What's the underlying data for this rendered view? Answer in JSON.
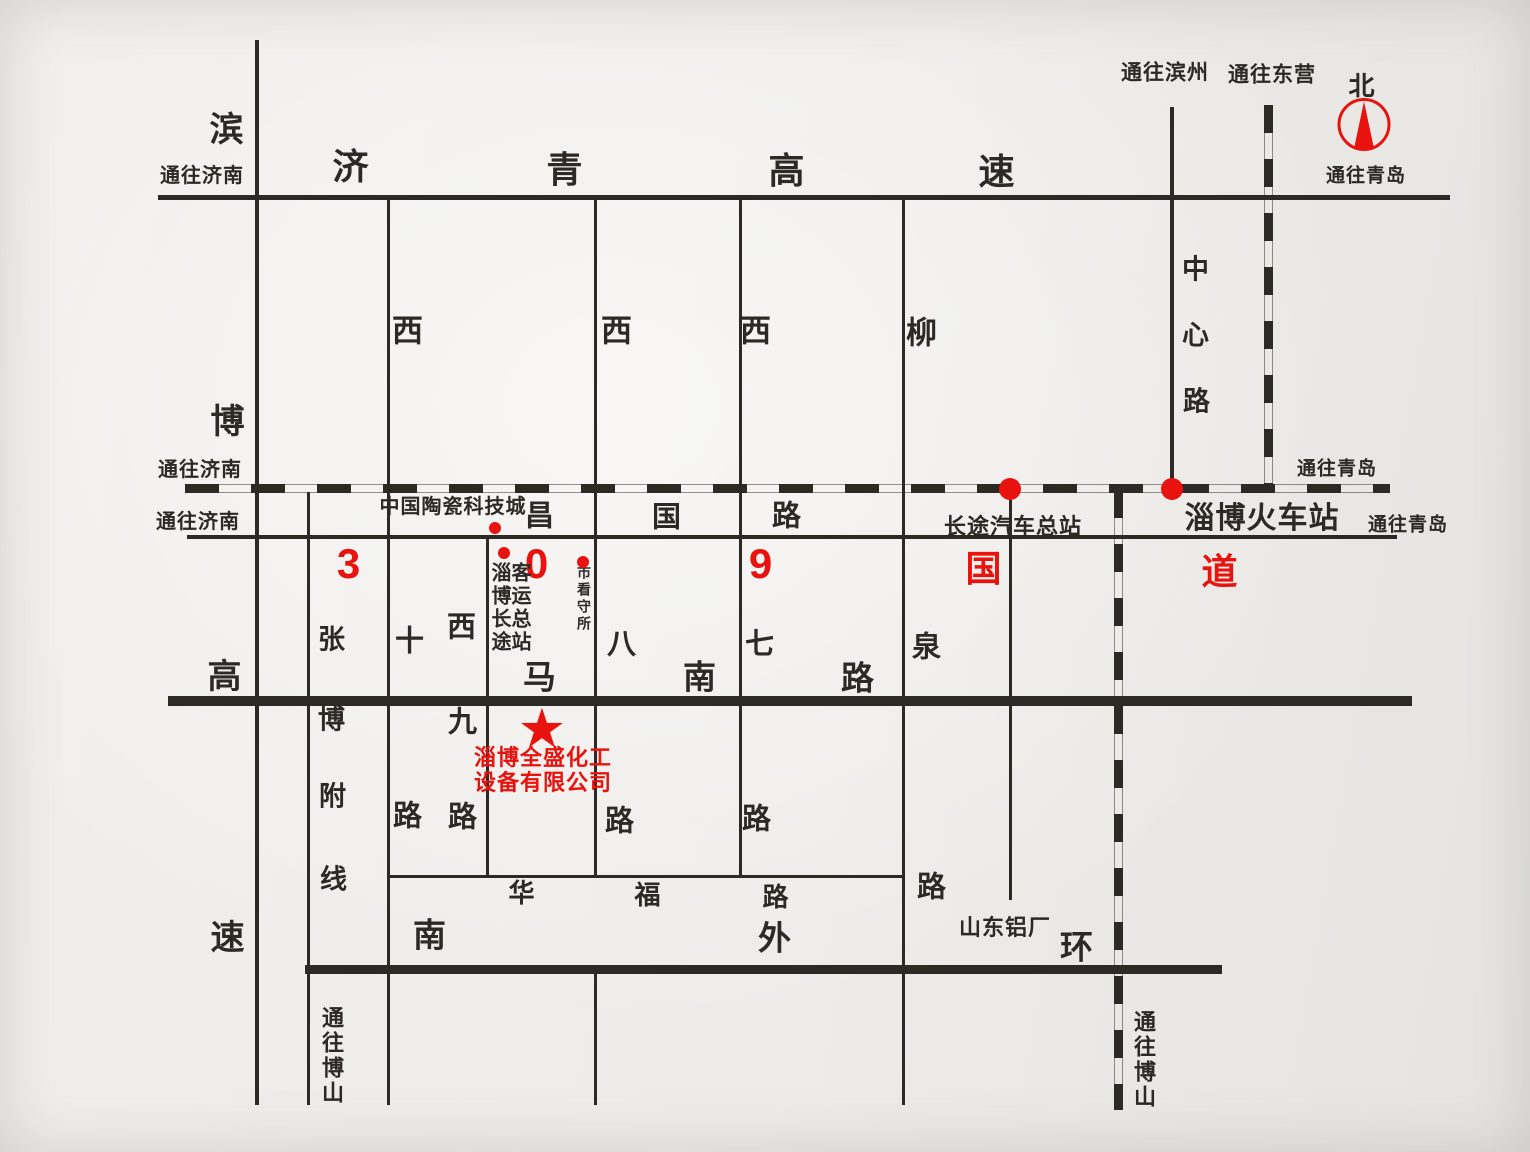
{
  "canvas": {
    "width": 1530,
    "height": 1152,
    "ink": "#2d2925",
    "red": "#e8120e"
  },
  "map_title": "淄博全盛化工设备有限公司位置示意图",
  "roads": [
    {
      "name": "jiqing-expressway",
      "orient": "h",
      "kind": "solid",
      "x": 158,
      "y": 197,
      "len": 1292,
      "w": 5
    },
    {
      "name": "railway-main",
      "orient": "h",
      "kind": "rail",
      "x": 185,
      "y": 488,
      "len": 1205,
      "w": 9
    },
    {
      "name": "changguo-road-g309",
      "orient": "h",
      "kind": "solid",
      "x": 187,
      "y": 537,
      "len": 1210,
      "w": 4
    },
    {
      "name": "manan-road",
      "orient": "h",
      "kind": "thick",
      "x": 168,
      "y": 701,
      "len": 1244,
      "w": 10
    },
    {
      "name": "huafu-road",
      "orient": "h",
      "kind": "solid",
      "x": 387,
      "y": 876,
      "len": 516,
      "w": 3
    },
    {
      "name": "nanwaihuan-road",
      "orient": "h",
      "kind": "thick",
      "x": 305,
      "y": 969,
      "len": 917,
      "w": 9
    },
    {
      "name": "binbo-expressway",
      "orient": "v",
      "kind": "solid",
      "x": 257,
      "y": 40,
      "len": 1065,
      "w": 4
    },
    {
      "name": "zhangbo-fuxian",
      "orient": "v",
      "kind": "solid",
      "x": 308,
      "y": 492,
      "len": 613,
      "w": 3
    },
    {
      "name": "xishi-road",
      "orient": "v",
      "kind": "solid",
      "x": 388,
      "y": 198,
      "len": 907,
      "w": 3
    },
    {
      "name": "xijiu-road",
      "orient": "v",
      "kind": "solid",
      "x": 487,
      "y": 537,
      "len": 339,
      "w": 3
    },
    {
      "name": "xiba-road-upper",
      "orient": "v",
      "kind": "solid",
      "x": 595,
      "y": 198,
      "len": 678,
      "w": 3
    },
    {
      "name": "xiba-road-lower",
      "orient": "v",
      "kind": "solid",
      "x": 595,
      "y": 969,
      "len": 136,
      "w": 3
    },
    {
      "name": "xiqi-road",
      "orient": "v",
      "kind": "solid",
      "x": 740,
      "y": 198,
      "len": 678,
      "w": 3
    },
    {
      "name": "liuquan-road",
      "orient": "v",
      "kind": "solid",
      "x": 903,
      "y": 198,
      "len": 907,
      "w": 3
    },
    {
      "name": "station-spur",
      "orient": "v",
      "kind": "solid",
      "x": 1010,
      "y": 490,
      "len": 410,
      "w": 3
    },
    {
      "name": "zhongxin-road",
      "orient": "v",
      "kind": "solid",
      "x": 1172,
      "y": 107,
      "len": 382,
      "w": 4
    },
    {
      "name": "railway-south-branch",
      "orient": "v",
      "kind": "rail",
      "x": 1118,
      "y": 490,
      "len": 620,
      "w": 9
    },
    {
      "name": "railway-north-branch",
      "orient": "v",
      "kind": "rail",
      "x": 1268,
      "y": 105,
      "len": 383,
      "w": 9
    }
  ],
  "labels": [
    {
      "n": "to-jinan-top",
      "t": "通往济南",
      "x": 202,
      "y": 176,
      "s": 20
    },
    {
      "n": "binbo-char-bin",
      "t": "滨",
      "x": 227,
      "y": 130,
      "s": 34
    },
    {
      "n": "jiqing-char-ji",
      "t": "济",
      "x": 351,
      "y": 167,
      "s": 36
    },
    {
      "n": "jiqing-char-qing",
      "t": "青",
      "x": 565,
      "y": 170,
      "s": 36
    },
    {
      "n": "jiqing-char-gao",
      "t": "高",
      "x": 787,
      "y": 171,
      "s": 36
    },
    {
      "n": "jiqing-char-su",
      "t": "速",
      "x": 997,
      "y": 172,
      "s": 36
    },
    {
      "n": "to-binzhou",
      "t": "通往滨州",
      "x": 1165,
      "y": 73,
      "s": 21
    },
    {
      "n": "to-dongying",
      "t": "通往东营",
      "x": 1272,
      "y": 75,
      "s": 21
    },
    {
      "n": "north-char",
      "t": "北",
      "x": 1362,
      "y": 86,
      "s": 26
    },
    {
      "n": "to-qingdao-compass",
      "t": "通往青岛",
      "x": 1366,
      "y": 176,
      "s": 19
    },
    {
      "n": "xishi-char-xi",
      "t": "西",
      "x": 408,
      "y": 331,
      "s": 31
    },
    {
      "n": "xiba-char-xi",
      "t": "西",
      "x": 617,
      "y": 331,
      "s": 31
    },
    {
      "n": "xiqi-char-xi",
      "t": "西",
      "x": 756,
      "y": 331,
      "s": 31
    },
    {
      "n": "liuquan-char-liu",
      "t": "柳",
      "x": 922,
      "y": 333,
      "s": 31
    },
    {
      "n": "zhongxin-char-zhong",
      "t": "中",
      "x": 1196,
      "y": 270,
      "s": 27
    },
    {
      "n": "zhongxin-char-xin",
      "t": "心",
      "x": 1196,
      "y": 336,
      "s": 27
    },
    {
      "n": "zhongxin-char-lu",
      "t": "路",
      "x": 1197,
      "y": 402,
      "s": 27
    },
    {
      "n": "binbo-char-bo",
      "t": "博",
      "x": 228,
      "y": 422,
      "s": 34
    },
    {
      "n": "to-jinan-rail",
      "t": "通往济南",
      "x": 200,
      "y": 470,
      "s": 20
    },
    {
      "n": "to-qingdao-rail",
      "t": "通往青岛",
      "x": 1337,
      "y": 469,
      "s": 19
    },
    {
      "n": "to-jinan-road",
      "t": "通往济南",
      "x": 198,
      "y": 522,
      "s": 20
    },
    {
      "n": "ceramics-city",
      "t": "中国陶瓷科技城",
      "x": 453,
      "y": 507,
      "s": 20
    },
    {
      "n": "changguo-char-chang",
      "t": "昌",
      "x": 540,
      "y": 517,
      "s": 29
    },
    {
      "n": "changguo-char-guo",
      "t": "国",
      "x": 667,
      "y": 518,
      "s": 29
    },
    {
      "n": "changguo-char-lu",
      "t": "路",
      "x": 787,
      "y": 517,
      "s": 29
    },
    {
      "n": "bus-terminal",
      "t": "长途汽车总站",
      "x": 1013,
      "y": 527,
      "s": 22
    },
    {
      "n": "train-station",
      "t": "淄博火车站",
      "x": 1262,
      "y": 519,
      "s": 30
    },
    {
      "n": "to-qingdao-road",
      "t": "通往青岛",
      "x": 1408,
      "y": 525,
      "s": 19
    },
    {
      "n": "g309-char-3",
      "t": "3",
      "x": 349,
      "y": 564,
      "s": 42,
      "c": "red"
    },
    {
      "n": "g309-char-0",
      "t": "0",
      "x": 537,
      "y": 564,
      "s": 42,
      "c": "red"
    },
    {
      "n": "g309-char-9",
      "t": "9",
      "x": 761,
      "y": 564,
      "s": 42,
      "c": "red"
    },
    {
      "n": "g309-char-guo",
      "t": "国",
      "x": 984,
      "y": 569,
      "s": 36,
      "c": "red"
    },
    {
      "n": "g309-char-dao",
      "t": "道",
      "x": 1220,
      "y": 572,
      "s": 36,
      "c": "red"
    },
    {
      "n": "coach-station-col1",
      "t": "淄博长途",
      "x": 499,
      "y": 608,
      "s": 20,
      "o": "v"
    },
    {
      "n": "coach-station-col2",
      "t": "客运总站",
      "x": 519,
      "y": 608,
      "s": 20,
      "o": "v"
    },
    {
      "n": "detention-house",
      "t": "市看守所",
      "x": 584,
      "y": 599,
      "s": 14,
      "o": "v"
    },
    {
      "n": "zhangbo-char-zhang",
      "t": "张",
      "x": 332,
      "y": 640,
      "s": 27
    },
    {
      "n": "xishi-char-shi",
      "t": "十",
      "x": 410,
      "y": 642,
      "s": 29
    },
    {
      "n": "xijiu-char-xi",
      "t": "西",
      "x": 462,
      "y": 628,
      "s": 29
    },
    {
      "n": "xiba-char-ba",
      "t": "八",
      "x": 622,
      "y": 645,
      "s": 29
    },
    {
      "n": "xiqi-char-qi",
      "t": "七",
      "x": 760,
      "y": 645,
      "s": 29
    },
    {
      "n": "liuquan-char-quan",
      "t": "泉",
      "x": 927,
      "y": 648,
      "s": 29
    },
    {
      "n": "binbo-char-gao",
      "t": "高",
      "x": 225,
      "y": 677,
      "s": 34
    },
    {
      "n": "manan-char-ma",
      "t": "马",
      "x": 540,
      "y": 677,
      "s": 33
    },
    {
      "n": "manan-char-nan",
      "t": "南",
      "x": 700,
      "y": 677,
      "s": 33
    },
    {
      "n": "manan-char-lu",
      "t": "路",
      "x": 858,
      "y": 678,
      "s": 33
    },
    {
      "n": "zhangbo-char-bo",
      "t": "博",
      "x": 332,
      "y": 720,
      "s": 27
    },
    {
      "n": "xijiu-char-jiu",
      "t": "九",
      "x": 463,
      "y": 723,
      "s": 29
    },
    {
      "n": "company-name-line1",
      "t": "淄博全盛化工",
      "x": 543,
      "y": 758,
      "s": 22,
      "c": "red"
    },
    {
      "n": "company-name-line2",
      "t": "设备有限公司",
      "x": 543,
      "y": 783,
      "s": 22,
      "c": "red"
    },
    {
      "n": "zhangbo-char-fu",
      "t": "附",
      "x": 333,
      "y": 797,
      "s": 27
    },
    {
      "n": "xishi-char-lu",
      "t": "路",
      "x": 408,
      "y": 817,
      "s": 29
    },
    {
      "n": "xijiu-char-lu",
      "t": "路",
      "x": 463,
      "y": 818,
      "s": 29
    },
    {
      "n": "xiba-char-lu",
      "t": "路",
      "x": 620,
      "y": 822,
      "s": 29
    },
    {
      "n": "xiqi-char-lu",
      "t": "路",
      "x": 757,
      "y": 820,
      "s": 29
    },
    {
      "n": "zhangbo-char-xian",
      "t": "线",
      "x": 334,
      "y": 880,
      "s": 27
    },
    {
      "n": "liuquan-char-lu",
      "t": "路",
      "x": 932,
      "y": 888,
      "s": 29
    },
    {
      "n": "huafu-char-hua",
      "t": "华",
      "x": 522,
      "y": 893,
      "s": 26
    },
    {
      "n": "huafu-char-fu",
      "t": "福",
      "x": 648,
      "y": 895,
      "s": 26
    },
    {
      "n": "huafu-char-lu",
      "t": "路",
      "x": 776,
      "y": 897,
      "s": 26
    },
    {
      "n": "shandong-aluminum",
      "t": "山东铝厂",
      "x": 1005,
      "y": 928,
      "s": 22
    },
    {
      "n": "waihuan-char-nan",
      "t": "南",
      "x": 430,
      "y": 935,
      "s": 33
    },
    {
      "n": "binbo-char-su",
      "t": "速",
      "x": 228,
      "y": 938,
      "s": 34
    },
    {
      "n": "waihuan-char-wai",
      "t": "外",
      "x": 775,
      "y": 938,
      "s": 33
    },
    {
      "n": "waihuan-char-huan",
      "t": "环",
      "x": 1077,
      "y": 947,
      "s": 33
    },
    {
      "n": "to-boshan-left",
      "t": "通往博山",
      "x": 331,
      "y": 1056,
      "s": 22,
      "o": "v"
    },
    {
      "n": "to-boshan-right",
      "t": "通往博山",
      "x": 1143,
      "y": 1060,
      "s": 22,
      "o": "v"
    }
  ],
  "markers": {
    "dots": [
      {
        "n": "ceramics-city-dot",
        "x": 495,
        "y": 528,
        "r": 6
      },
      {
        "n": "coach-station-dot",
        "x": 504,
        "y": 553,
        "r": 6
      },
      {
        "n": "detention-house-dot",
        "x": 583,
        "y": 562,
        "r": 6
      },
      {
        "n": "bus-terminal-dot",
        "x": 1010,
        "y": 489,
        "r": 11
      },
      {
        "n": "train-station-dot",
        "x": 1172,
        "y": 489,
        "r": 11
      }
    ],
    "company_star": {
      "glyph": "★",
      "x": 542,
      "y": 729,
      "s": 54
    },
    "compass": {
      "x": 1364,
      "y": 129,
      "r": 26
    }
  }
}
